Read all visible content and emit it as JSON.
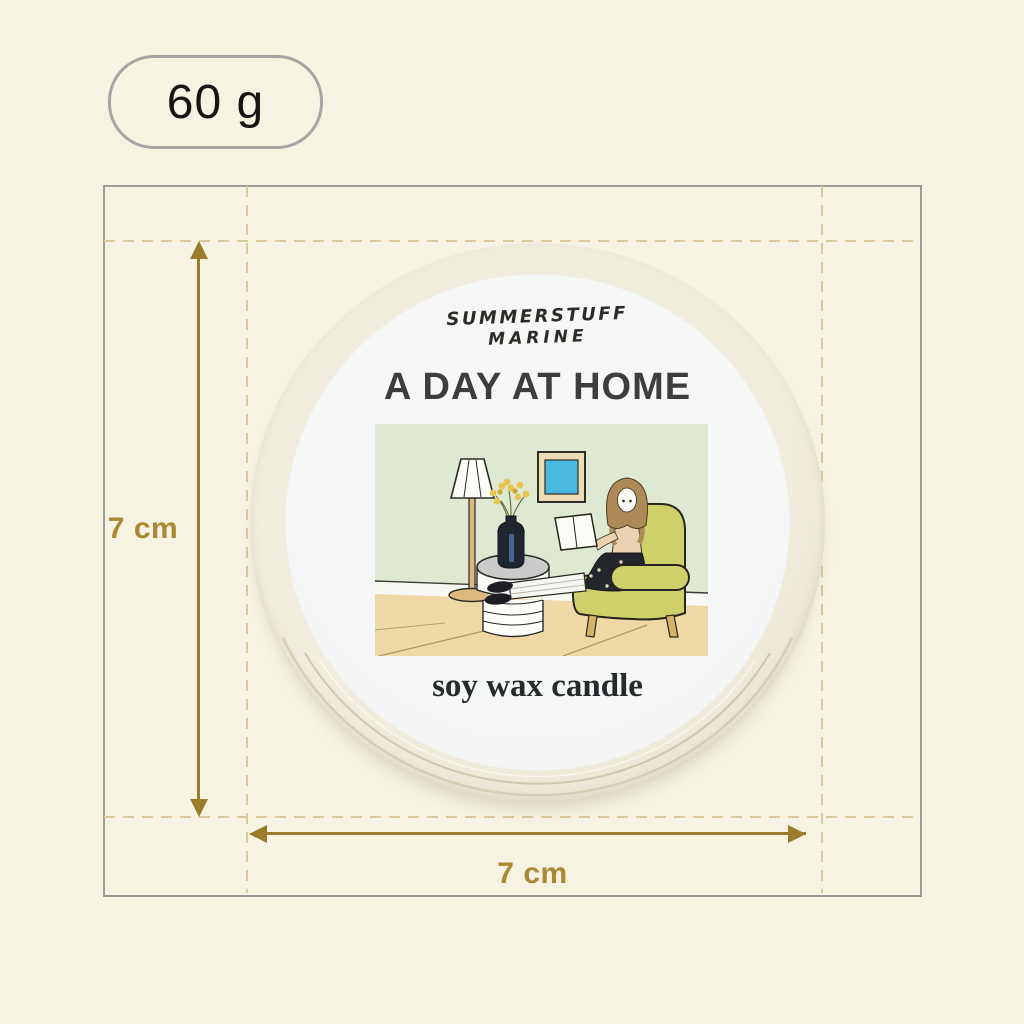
{
  "badge": {
    "weight_label": "60 g"
  },
  "dimensions": {
    "height_label": "7 cm",
    "width_label": "7 cm"
  },
  "tin_label": {
    "brand_line1": "SUMMERSTUFF",
    "brand_line2": "MARINE",
    "title": "A DAY AT HOME",
    "subtitle": "soy wax candle",
    "illustration_elements": [
      "floor-lamp",
      "side-table",
      "vase-with-yellow-flowers",
      "blue-picture-frame",
      "yellow-armchair",
      "woman-reading-book"
    ]
  },
  "colors": {
    "background": "#f6f3e2",
    "frame_border": "#9b9b9b",
    "dashed_guides": "#dcc99b",
    "dimension_accent": "#9a7c2c",
    "dimension_label": "#ab8834",
    "badge_border": "#a5a5a5",
    "tin_body": "#ece7d6",
    "tin_label_paper": "#f5f7f6",
    "illustration_wall": "#dee8d3",
    "illustration_floor": "#eed9a6",
    "armchair": "#ced06a",
    "picture_blue": "#49b9e2"
  }
}
